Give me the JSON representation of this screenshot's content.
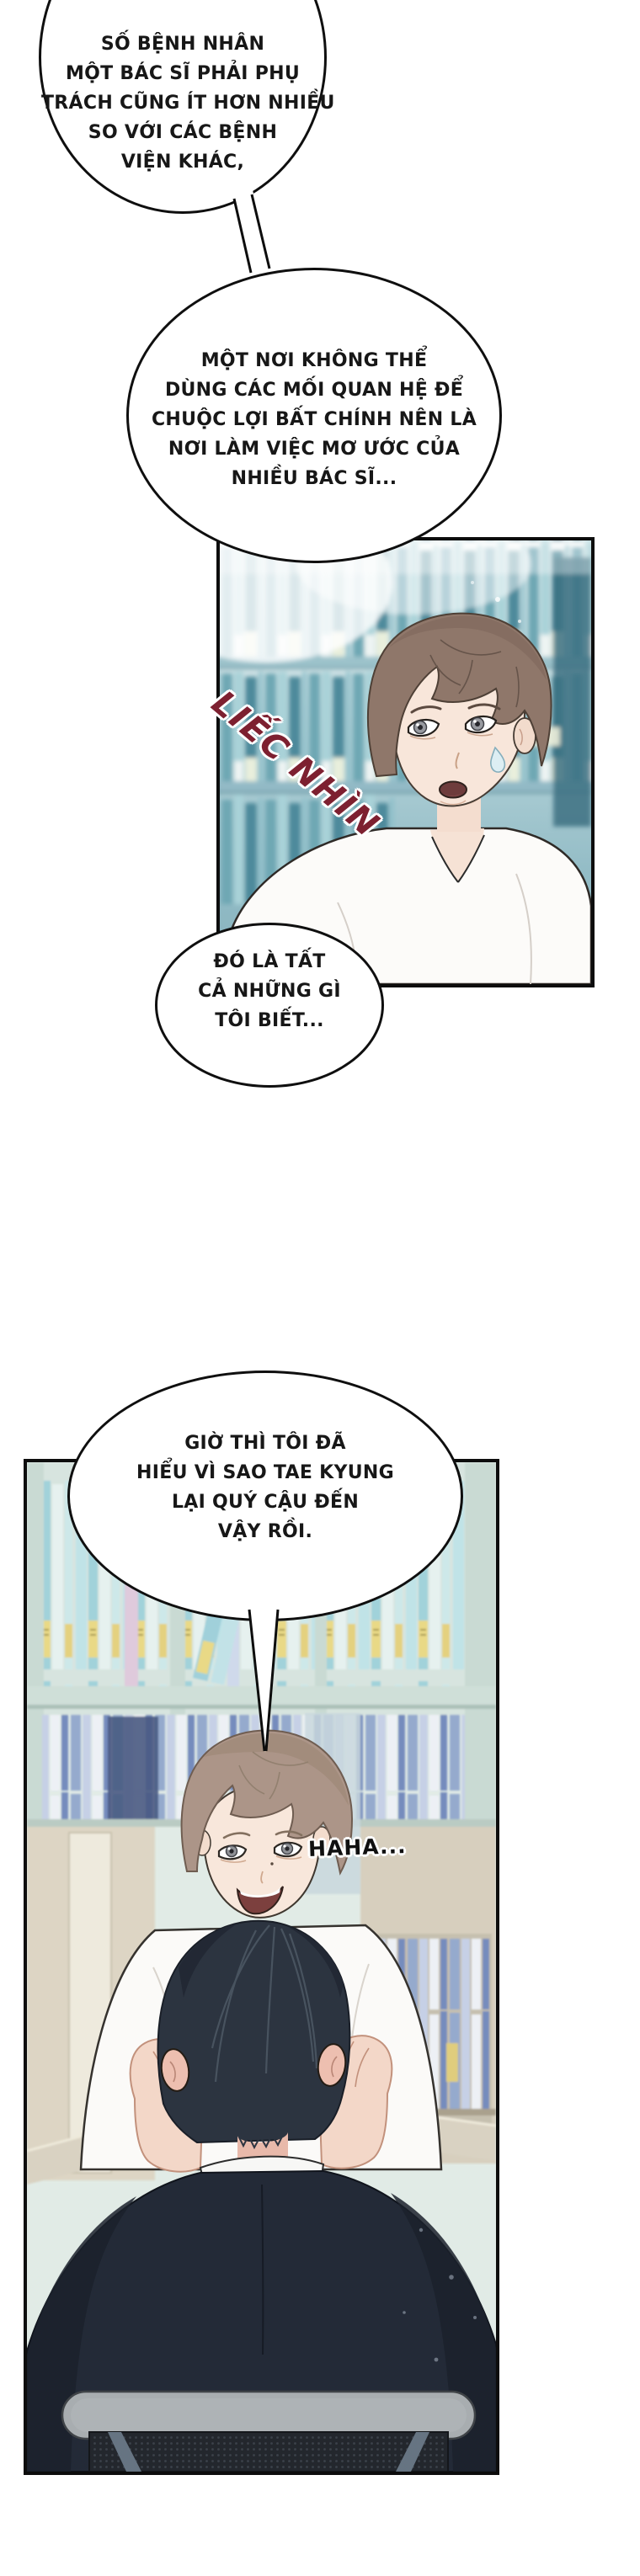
{
  "comic": {
    "speech_bubbles": [
      {
        "id": "bubble-1",
        "lines": [
          "SỐ BỆNH NHÂN",
          "MỘT BÁC SĨ PHẢI PHỤ",
          "TRÁCH CŨNG ÍT HƠN NHIỀU",
          "SO VỚI CÁC BỆNH",
          "VIỆN KHÁC,"
        ]
      },
      {
        "id": "bubble-2",
        "lines": [
          "MỘT NƠI KHÔNG THỂ",
          "DÙNG CÁC MỐI QUAN HỆ ĐỂ",
          "CHUỘC LỢI BẤT CHÍNH NÊN LÀ",
          "NƠI LÀM VIỆC MƠ ƯỚC CỦA",
          "NHIỀU BÁC SĨ..."
        ]
      },
      {
        "id": "bubble-3",
        "lines": [
          "ĐÓ LÀ TẤT",
          "CẢ NHỮNG GÌ",
          "TÔI BIẾT..."
        ]
      },
      {
        "id": "bubble-4",
        "lines": [
          "GIỜ THÌ TÔI ĐÃ",
          "HIỂU VÌ SAO TAE KYUNG",
          "LẠI QUÝ CẬU ĐẾN",
          "VẬY RỒI."
        ]
      }
    ],
    "sfx": {
      "text": "LIẾC NHÌN",
      "color": "#7d2030"
    },
    "laugh": {
      "text": "HAHA...",
      "color": "#101010"
    },
    "colors": {
      "panel1_teal": "#8fb9c4",
      "panel2_shelf": "#d7e4df",
      "suit_navy": "#232a37",
      "hair_brown": "#8f776a",
      "hair_ash": "#ac9588",
      "bubble_border": "#0f0f0f"
    }
  }
}
